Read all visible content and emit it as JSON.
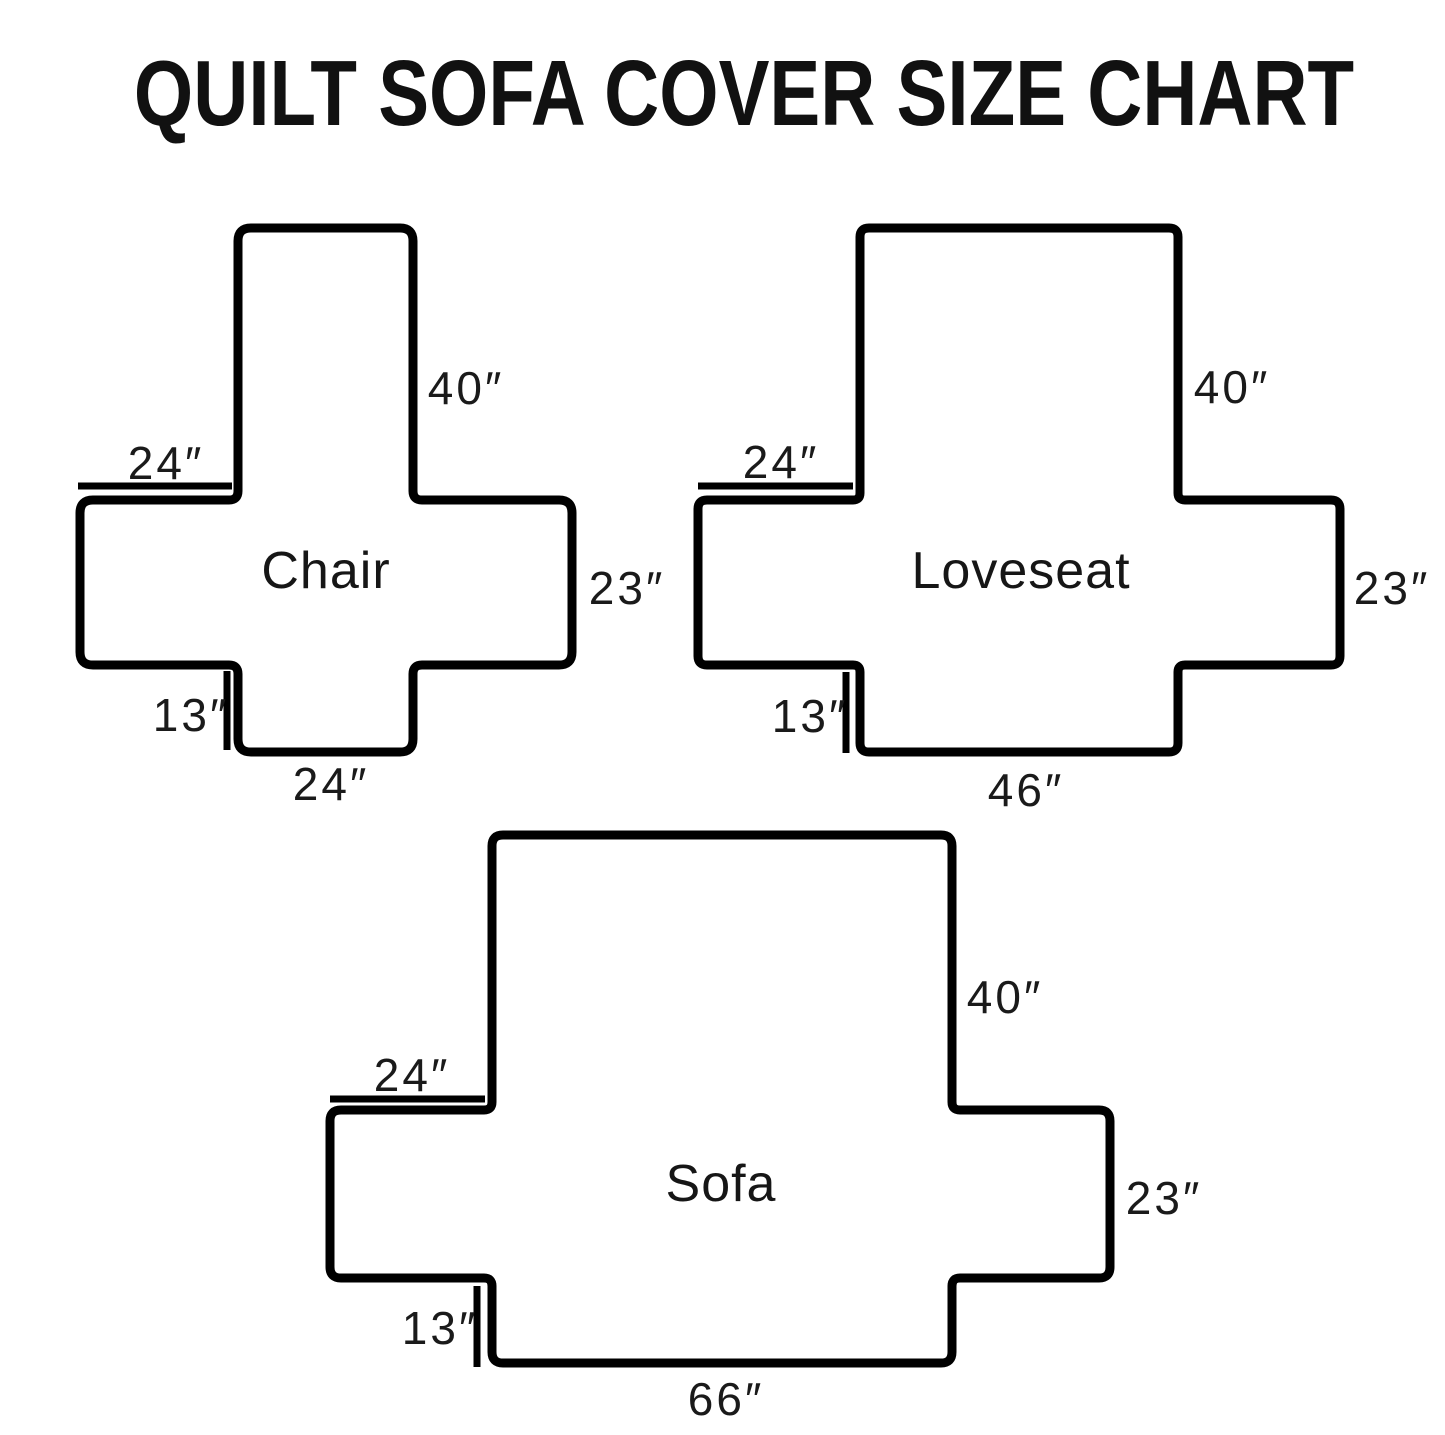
{
  "title": "QUILT SOFA COVER SIZE CHART",
  "colors": {
    "outline": "#000000",
    "dimension_line": "#000000",
    "text": "#1a1a1a",
    "background": "#ffffff"
  },
  "diagrams": [
    {
      "name": "Chair",
      "back_height": "40″",
      "arm_top_width": "24″",
      "side_height": "23″",
      "front_drop": "13″",
      "seat_width": "24″"
    },
    {
      "name": "Loveseat",
      "back_height": "40″",
      "arm_top_width": "24″",
      "side_height": "23″",
      "front_drop": "13″",
      "seat_width": "46″"
    },
    {
      "name": "Sofa",
      "back_height": "40″",
      "arm_top_width": "24″",
      "side_height": "23″",
      "front_drop": "13″",
      "seat_width": "66″"
    }
  ]
}
